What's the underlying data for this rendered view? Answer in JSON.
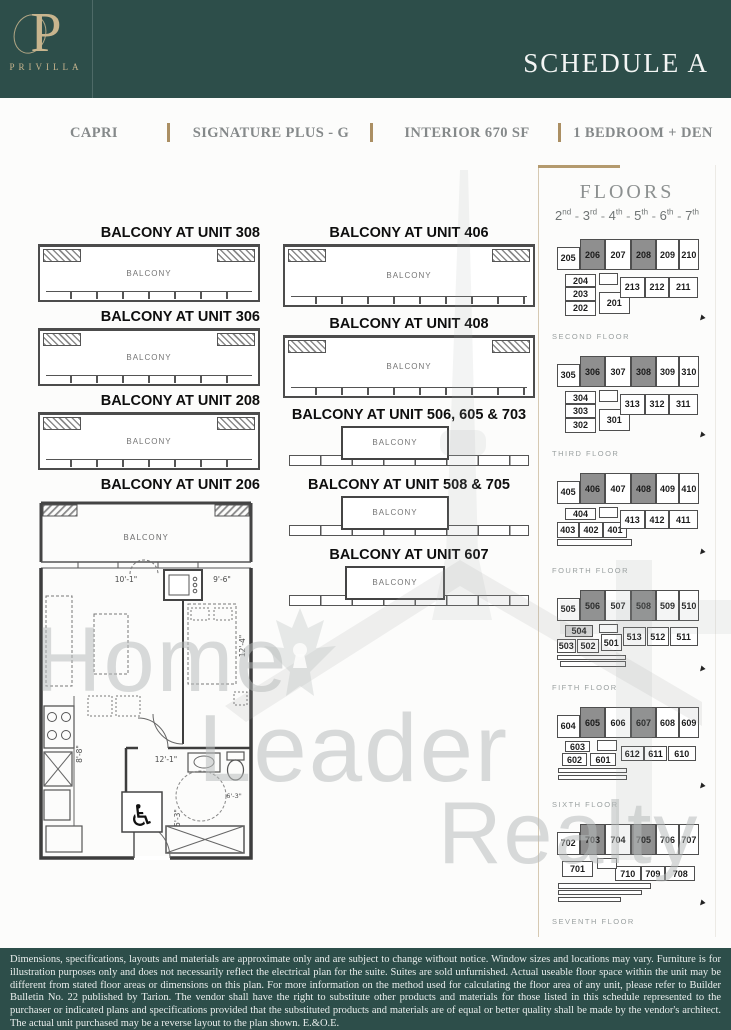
{
  "header": {
    "brand": "PRIVILLA",
    "monogram": "P",
    "schedule_title": "SCHEDULE A"
  },
  "subheader": {
    "items": [
      "CAPRI",
      "SIGNATURE PLUS - G",
      "INTERIOR 670 SF",
      "1 BEDROOM + DEN"
    ]
  },
  "balconies": {
    "label": "BALCONY",
    "left": [
      {
        "title": "BALCONY AT UNIT 308"
      },
      {
        "title": "BALCONY AT UNIT 306"
      },
      {
        "title": "BALCONY AT UNIT 208"
      }
    ],
    "middle": [
      {
        "title": "BALCONY AT UNIT 406",
        "style": "wide"
      },
      {
        "title": "BALCONY AT UNIT 408",
        "style": "wide"
      },
      {
        "title": "BALCONY AT UNIT 506, 605 & 703",
        "style": "narrow"
      },
      {
        "title": "BALCONY AT UNIT 508 & 705",
        "style": "narrow"
      },
      {
        "title": "BALCONY AT UNIT 607",
        "style": "narrow"
      }
    ]
  },
  "unit_plan": {
    "title": "BALCONY AT UNIT 206",
    "balcony_label": "BALCONY",
    "dims": {
      "living_width": "10'-1\"",
      "bed_width": "9'-6\"",
      "bed_length": "12'-4\"",
      "hall_length": "12'-1\"",
      "bath_width": "5'-3\"",
      "kitchen_length": "8'-8\"",
      "entry_width": "6'-3\""
    }
  },
  "floors_panel": {
    "title": "FLOORS",
    "range": [
      {
        "num": "2",
        "suffix": "nd"
      },
      {
        "num": "3",
        "suffix": "rd"
      },
      {
        "num": "4",
        "suffix": "th"
      },
      {
        "num": "5",
        "suffix": "th"
      },
      {
        "num": "6",
        "suffix": "th"
      },
      {
        "num": "7",
        "suffix": "th"
      }
    ],
    "highlight_colors": {
      "primary": "#8f8f8f",
      "secondary": "#d9d9d9"
    },
    "floors": [
      {
        "name": "SECOND FLOOR",
        "cells": [
          {
            "t": "206",
            "x": 18.5,
            "y": 2,
            "w": 17,
            "h": 34,
            "f": "d"
          },
          {
            "t": "207",
            "x": 35.5,
            "y": 2,
            "w": 17,
            "h": 34
          },
          {
            "t": "208",
            "x": 52.5,
            "y": 2,
            "w": 17,
            "h": 34,
            "f": "d"
          },
          {
            "t": "209",
            "x": 69.5,
            "y": 2,
            "w": 15,
            "h": 34
          },
          {
            "t": "210",
            "x": 84.5,
            "y": 2,
            "w": 13.5,
            "h": 34
          },
          {
            "t": "205",
            "x": 3,
            "y": 10,
            "w": 15.5,
            "h": 26
          },
          {
            "t": "204",
            "x": 8.5,
            "y": 40,
            "w": 21,
            "h": 14.5
          },
          {
            "t": "203",
            "x": 8.5,
            "y": 54.5,
            "w": 21,
            "h": 14.5
          },
          {
            "t": "202",
            "x": 8.5,
            "y": 69,
            "w": 21,
            "h": 16
          },
          {
            "t": "201",
            "x": 31,
            "y": 59,
            "w": 21,
            "h": 24
          },
          {
            "t": "213",
            "x": 45,
            "y": 43,
            "w": 17,
            "h": 23
          },
          {
            "t": "212",
            "x": 62,
            "y": 43,
            "w": 16,
            "h": 23
          },
          {
            "t": "211",
            "x": 78,
            "y": 43,
            "w": 19,
            "h": 23
          },
          {
            "t": "",
            "x": 31,
            "y": 39,
            "w": 13,
            "h": 13
          }
        ]
      },
      {
        "name": "THIRD FLOOR",
        "cells": [
          {
            "t": "306",
            "x": 18.5,
            "y": 2,
            "w": 17,
            "h": 34,
            "f": "d"
          },
          {
            "t": "307",
            "x": 35.5,
            "y": 2,
            "w": 17,
            "h": 34
          },
          {
            "t": "308",
            "x": 52.5,
            "y": 2,
            "w": 17,
            "h": 34,
            "f": "d"
          },
          {
            "t": "309",
            "x": 69.5,
            "y": 2,
            "w": 15,
            "h": 34
          },
          {
            "t": "310",
            "x": 84.5,
            "y": 2,
            "w": 13.5,
            "h": 34
          },
          {
            "t": "305",
            "x": 3,
            "y": 10,
            "w": 15.5,
            "h": 26
          },
          {
            "t": "304",
            "x": 8.5,
            "y": 40,
            "w": 21,
            "h": 14.5
          },
          {
            "t": "303",
            "x": 8.5,
            "y": 54.5,
            "w": 21,
            "h": 14.5
          },
          {
            "t": "302",
            "x": 8.5,
            "y": 69,
            "w": 21,
            "h": 16
          },
          {
            "t": "301",
            "x": 31,
            "y": 59,
            "w": 21,
            "h": 24
          },
          {
            "t": "313",
            "x": 45,
            "y": 43,
            "w": 17,
            "h": 23
          },
          {
            "t": "312",
            "x": 62,
            "y": 43,
            "w": 16,
            "h": 23
          },
          {
            "t": "311",
            "x": 78,
            "y": 43,
            "w": 19,
            "h": 23
          },
          {
            "t": "",
            "x": 31,
            "y": 39,
            "w": 13,
            "h": 13
          }
        ]
      },
      {
        "name": "FOURTH FLOOR",
        "cells": [
          {
            "t": "406",
            "x": 18.5,
            "y": 2,
            "w": 17,
            "h": 34,
            "f": "d"
          },
          {
            "t": "407",
            "x": 35.5,
            "y": 2,
            "w": 17,
            "h": 34
          },
          {
            "t": "408",
            "x": 52.5,
            "y": 2,
            "w": 17,
            "h": 34,
            "f": "d"
          },
          {
            "t": "409",
            "x": 69.5,
            "y": 2,
            "w": 15,
            "h": 34
          },
          {
            "t": "410",
            "x": 84.5,
            "y": 2,
            "w": 13.5,
            "h": 34
          },
          {
            "t": "405",
            "x": 3,
            "y": 10,
            "w": 15.5,
            "h": 26
          },
          {
            "t": "404",
            "x": 8.5,
            "y": 40,
            "w": 21,
            "h": 13
          },
          {
            "t": "403",
            "x": 3,
            "y": 55,
            "w": 15,
            "h": 17
          },
          {
            "t": "402",
            "x": 18,
            "y": 55,
            "w": 16,
            "h": 17
          },
          {
            "t": "401",
            "x": 34,
            "y": 55,
            "w": 16,
            "h": 17
          },
          {
            "t": "413",
            "x": 45,
            "y": 42,
            "w": 17,
            "h": 21
          },
          {
            "t": "412",
            "x": 62,
            "y": 42,
            "w": 16,
            "h": 21
          },
          {
            "t": "411",
            "x": 78,
            "y": 42,
            "w": 19,
            "h": 21
          },
          {
            "t": "",
            "x": 31,
            "y": 39,
            "w": 13,
            "h": 12
          },
          {
            "t": "",
            "x": 3,
            "y": 74,
            "w": 50,
            "h": 7
          }
        ]
      },
      {
        "name": "FIFTH FLOOR",
        "cells": [
          {
            "t": "506",
            "x": 18.5,
            "y": 2,
            "w": 17,
            "h": 34,
            "f": "d"
          },
          {
            "t": "507",
            "x": 35.5,
            "y": 2,
            "w": 17,
            "h": 34
          },
          {
            "t": "508",
            "x": 52.5,
            "y": 2,
            "w": 17,
            "h": 34,
            "f": "d"
          },
          {
            "t": "509",
            "x": 69.5,
            "y": 2,
            "w": 15,
            "h": 34
          },
          {
            "t": "510",
            "x": 84.5,
            "y": 2,
            "w": 13.5,
            "h": 34
          },
          {
            "t": "505",
            "x": 3,
            "y": 10,
            "w": 15.5,
            "h": 26
          },
          {
            "t": "504",
            "x": 8.5,
            "y": 40,
            "w": 19,
            "h": 13,
            "f": "l"
          },
          {
            "t": "503",
            "x": 3,
            "y": 55,
            "w": 13,
            "h": 15
          },
          {
            "t": "502",
            "x": 16.5,
            "y": 55,
            "w": 15,
            "h": 15
          },
          {
            "t": "501",
            "x": 32.5,
            "y": 50,
            "w": 14,
            "h": 18
          },
          {
            "t": "513",
            "x": 47,
            "y": 42,
            "w": 15.5,
            "h": 21
          },
          {
            "t": "512",
            "x": 63,
            "y": 42,
            "w": 15,
            "h": 21
          },
          {
            "t": "511",
            "x": 78.5,
            "y": 42,
            "w": 18.5,
            "h": 21
          },
          {
            "t": "",
            "x": 31,
            "y": 39,
            "w": 13,
            "h": 10
          },
          {
            "t": "",
            "x": 3,
            "y": 72,
            "w": 46,
            "h": 6
          },
          {
            "t": "",
            "x": 5,
            "y": 79,
            "w": 44,
            "h": 6
          }
        ]
      },
      {
        "name": "SIXTH FLOOR",
        "cells": [
          {
            "t": "605",
            "x": 18.5,
            "y": 2,
            "w": 17,
            "h": 34,
            "f": "d"
          },
          {
            "t": "606",
            "x": 35.5,
            "y": 2,
            "w": 17,
            "h": 34
          },
          {
            "t": "607",
            "x": 52.5,
            "y": 2,
            "w": 17,
            "h": 34,
            "f": "d"
          },
          {
            "t": "608",
            "x": 69.5,
            "y": 2,
            "w": 15,
            "h": 34
          },
          {
            "t": "609",
            "x": 84.5,
            "y": 2,
            "w": 13.5,
            "h": 34
          },
          {
            "t": "604",
            "x": 3,
            "y": 10,
            "w": 15.5,
            "h": 26
          },
          {
            "t": "603",
            "x": 8.5,
            "y": 39,
            "w": 17,
            "h": 12
          },
          {
            "t": "602",
            "x": 6.5,
            "y": 52,
            "w": 17,
            "h": 14
          },
          {
            "t": "601",
            "x": 25.5,
            "y": 52,
            "w": 17,
            "h": 14
          },
          {
            "t": "612",
            "x": 46,
            "y": 44,
            "w": 15,
            "h": 17
          },
          {
            "t": "611",
            "x": 61.5,
            "y": 44,
            "w": 15,
            "h": 17
          },
          {
            "t": "610",
            "x": 77,
            "y": 44,
            "w": 19,
            "h": 17
          },
          {
            "t": "",
            "x": 30,
            "y": 38,
            "w": 13,
            "h": 12
          },
          {
            "t": "",
            "x": 4,
            "y": 68,
            "w": 46,
            "h": 6
          },
          {
            "t": "",
            "x": 4,
            "y": 75.5,
            "w": 46,
            "h": 6
          }
        ]
      },
      {
        "name": "SEVENTH FLOOR",
        "cells": [
          {
            "t": "703",
            "x": 18.5,
            "y": 2,
            "w": 17,
            "h": 34,
            "f": "d"
          },
          {
            "t": "704",
            "x": 35.5,
            "y": 2,
            "w": 17,
            "h": 34
          },
          {
            "t": "705",
            "x": 52.5,
            "y": 2,
            "w": 17,
            "h": 34,
            "f": "d"
          },
          {
            "t": "706",
            "x": 69.5,
            "y": 2,
            "w": 15,
            "h": 34
          },
          {
            "t": "707",
            "x": 84.5,
            "y": 2,
            "w": 13.5,
            "h": 34
          },
          {
            "t": "702",
            "x": 3,
            "y": 10,
            "w": 15.5,
            "h": 26
          },
          {
            "t": "701",
            "x": 6.5,
            "y": 42,
            "w": 21,
            "h": 17
          },
          {
            "t": "710",
            "x": 42,
            "y": 48,
            "w": 17,
            "h": 16
          },
          {
            "t": "709",
            "x": 59.5,
            "y": 48,
            "w": 15.5,
            "h": 16
          },
          {
            "t": "708",
            "x": 75.5,
            "y": 48,
            "w": 20,
            "h": 16
          },
          {
            "t": "",
            "x": 30,
            "y": 39,
            "w": 13,
            "h": 12
          },
          {
            "t": "",
            "x": 4,
            "y": 66,
            "w": 62,
            "h": 6
          },
          {
            "t": "",
            "x": 4,
            "y": 73.5,
            "w": 56,
            "h": 6
          },
          {
            "t": "",
            "x": 4,
            "y": 81,
            "w": 42,
            "h": 6
          }
        ]
      }
    ]
  },
  "watermark": {
    "lines": [
      "Home",
      "Leader",
      "Realty"
    ]
  },
  "footer": {
    "disclaimer": "Dimensions, specifications, layouts and materials are approximate only and are subject to change without notice. Window sizes and locations may vary. Furniture is for illustration purposes only and does not necessarily reflect the electrical plan for the suite. Suites are sold unfurnished. Actual useable floor space within the unit may be different from stated floor areas or dimensions on this plan. For more information on the method used for calculating the floor area of any unit, please refer to Builder Bulletin No. 22 published by Tarion. The vendor shall have the right to substitute other products and materials for those listed in this schedule represented to the purchaser or indicated plans and specifications provided that the substituted products and materials are of equal or better quality shall be made by the vendor's architect. The actual unit purchased may be a reverse layout to the plan shown. E.&O.E."
  }
}
